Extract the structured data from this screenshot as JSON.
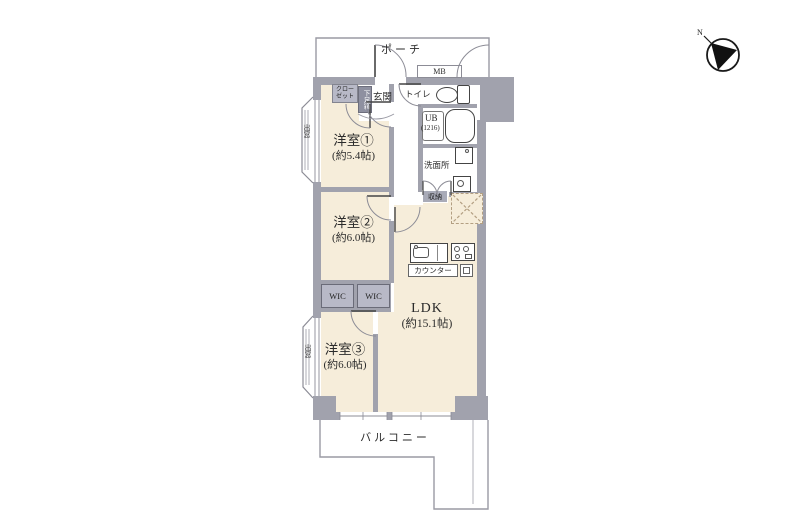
{
  "title": "3LDK floor plan",
  "colors": {
    "wall": "#a1a2ad",
    "floor": "#f6edda",
    "wic-fill": "#b8b9c7",
    "closet-fill": "#b8b9c7",
    "shoebox-fill": "#8e90a0",
    "storage-fill": "#a9abb8",
    "line": "#8c8c96",
    "hatch": "#b39f82",
    "text": "#2b2b2b"
  },
  "rooms": {
    "porch": {
      "label": "ポーチ"
    },
    "mb": {
      "label": "MB"
    },
    "toilet": {
      "label": "トイレ"
    },
    "bath": {
      "label": "UB",
      "size": "(1216)"
    },
    "washroom": {
      "label": "洗面所"
    },
    "storage": {
      "label": "収納"
    },
    "counter": {
      "label": "カウンター"
    },
    "ldk": {
      "label": "LDK",
      "size": "(約15.1帖)"
    },
    "room1": {
      "label": "洋室①",
      "size": "(約5.4帖)"
    },
    "room2": {
      "label": "洋室②",
      "size": "(約6.0帖)"
    },
    "room3": {
      "label": "洋室③",
      "size": "(約6.0帖)"
    },
    "wic1": {
      "label": "WIC"
    },
    "wic2": {
      "label": "WIC"
    },
    "closet": {
      "label_line1": "クロー",
      "label_line2": "ゼット"
    },
    "shoebox": {
      "label": "下足箱"
    },
    "genkan": {
      "label": "玄関"
    },
    "bay_window_top": {
      "label": "出窓"
    },
    "bay_window_bottom": {
      "label": "出窓"
    },
    "balcony": {
      "label": "バルコニー"
    }
  },
  "compass": {
    "north_label": "N"
  }
}
